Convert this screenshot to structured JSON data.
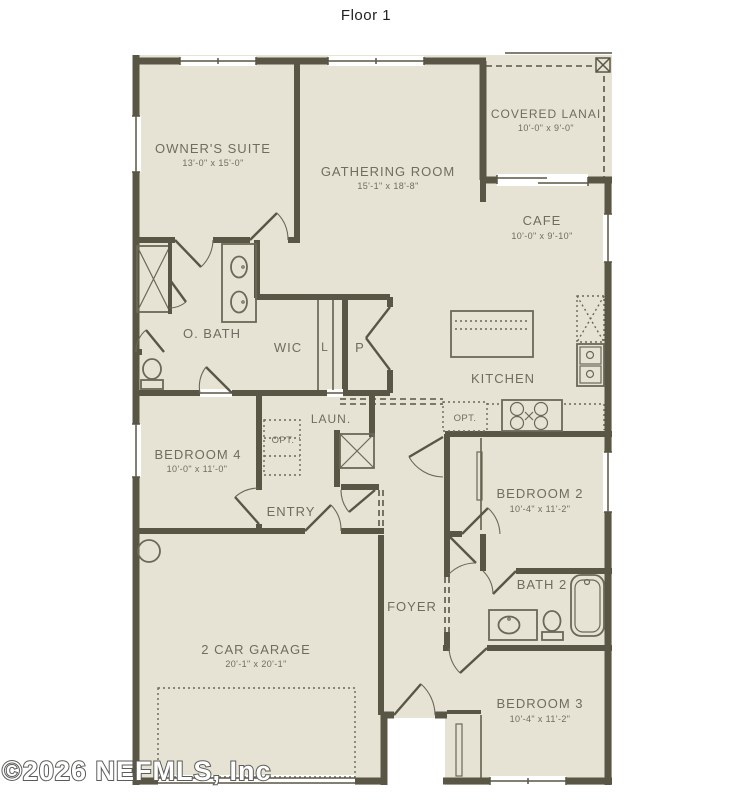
{
  "title": "Floor 1",
  "watermark": "©2026 NEFMLS, Inc",
  "colors": {
    "background": "#ffffff",
    "floor": "#e6e3d4",
    "wall": "#5a5645",
    "label_text": "#6f6d5f"
  },
  "rooms": {
    "owners_suite": {
      "name": "OWNER'S SUITE",
      "dims": "13'-0\" x 15'-0\""
    },
    "gathering_room": {
      "name": "GATHERING ROOM",
      "dims": "15'-1\" x 18'-8\""
    },
    "covered_lanai": {
      "name": "COVERED LANAI",
      "dims": "10'-0\" x 9'-0\""
    },
    "cafe": {
      "name": "CAFE",
      "dims": "10'-0\" x 9'-10\""
    },
    "owners_bath": {
      "name": "O. BATH"
    },
    "wic": {
      "name": "WIC"
    },
    "linen": {
      "name": "L"
    },
    "pantry": {
      "name": "P"
    },
    "kitchen": {
      "name": "KITCHEN"
    },
    "laundry": {
      "name": "LAUN."
    },
    "opt_laundry": {
      "name": "OPT."
    },
    "opt_kitchen": {
      "name": "OPT."
    },
    "bedroom4": {
      "name": "BEDROOM 4",
      "dims": "10'-0\" x 11'-0\""
    },
    "entry": {
      "name": "ENTRY"
    },
    "bedroom2": {
      "name": "BEDROOM 2",
      "dims": "10'-4\" x 11'-2\""
    },
    "bath2": {
      "name": "BATH 2"
    },
    "foyer": {
      "name": "FOYER"
    },
    "garage": {
      "name": "2 CAR GARAGE",
      "dims": "20'-1\" x 20'-1\""
    },
    "bedroom3": {
      "name": "BEDROOM 3",
      "dims": "10'-4\" x 11'-2\""
    }
  }
}
